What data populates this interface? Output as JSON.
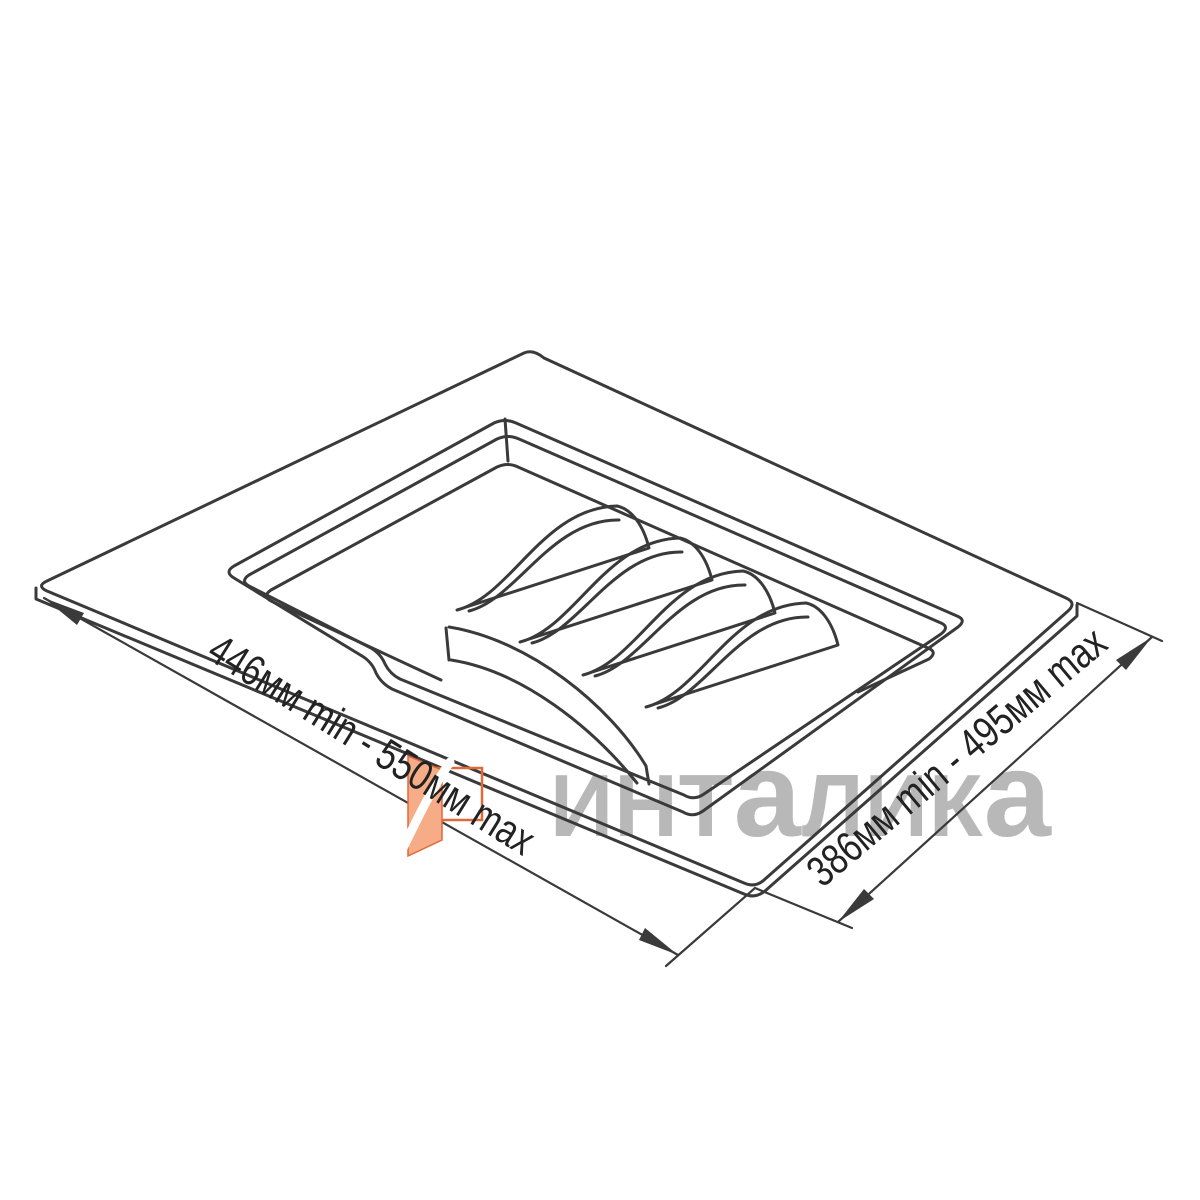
{
  "drawing": {
    "subject": "cutlery-tray-drawer-insert",
    "view": "isometric-line-drawing",
    "compartments": 2,
    "plate_divider_fins": 5
  },
  "dimensions": {
    "width": {
      "label": "446мм min - 550мм max",
      "min_mm": 446,
      "max_mm": 550,
      "unit": "мм",
      "position": "bottom-left-edge"
    },
    "depth": {
      "label": "386мм min - 495мм max",
      "min_mm": 386,
      "max_mm": 495,
      "unit": "мм",
      "position": "bottom-right-edge"
    }
  },
  "watermark": {
    "brand_text": "ИНТаЛИКа",
    "parts": [
      "ИНТ",
      "а",
      "ЛИК",
      "а"
    ]
  },
  "colors": {
    "background": "#ffffff",
    "line": "#3a3a3a",
    "dimension_text": "#222222",
    "watermark_text": "#b8b8b8",
    "logo_frame": "#e0693a",
    "logo_leaf": "#f6ad87"
  }
}
